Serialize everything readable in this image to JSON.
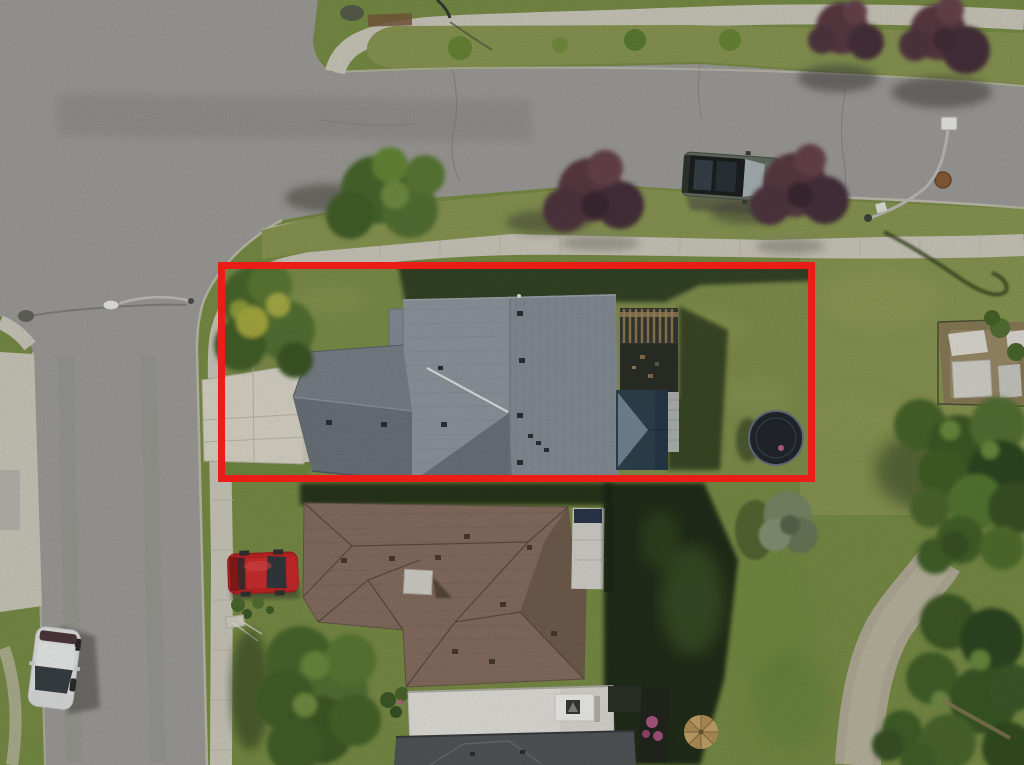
{
  "scene": {
    "kind": "aerial-drone-photo",
    "subject": "suburban corner lot outlined with red property boundary",
    "annotation": "red rectangle marking listed property"
  },
  "colors": {
    "asphalt": "#a2a19d",
    "asphalt_dark": "#8d8d89",
    "concrete": "#d2cec1",
    "concrete_bright": "#e0dccd",
    "grass": "#7c9148",
    "grass_olive": "#8d9b55",
    "lot_lawn": "#85934f",
    "grass_shadow": "#243019",
    "tree_green": "#4c6a2e",
    "tree_green_light": "#678c38",
    "tree_yellow": "#bcbc47",
    "tree_purple": "#5b3b45",
    "tree_purple_dark": "#452f38",
    "spruce": "#7d8b69",
    "roof_gray": "#8a929a",
    "roof_gray_light": "#939ba3",
    "roof_gray_dark": "#6e7680",
    "roof_brown": "#8a7263",
    "roof_brown_dark": "#74604f",
    "roof_charcoal": "#54585b",
    "flat_roof": "#e9e8e1",
    "teal_roof": "#2f4450",
    "teal_roof_light": "#8093a0",
    "pergola_wood": "#9b8257",
    "pergola_dark": "#363a33",
    "deck_gray": "#b5b9b5",
    "boundary_red": "#ea1d17",
    "trampoline": "#23282e",
    "trampoline_rim": "#6b7380",
    "car_white": "#e9eaea",
    "car_red": "#c52525",
    "suv_body": "#667062",
    "glass_dark": "#333b40",
    "lamp_white": "#f0f0ec",
    "lamp_pole": "#c2c2be",
    "path_gravel": "#b7b19c",
    "manhole": "#8a5f3a",
    "garden_dirt": "#8d7c5b",
    "shed_white": "#e5e3da",
    "flower_pink": "#c05f92"
  },
  "objects": {
    "boundary": "property-boundary",
    "main_house": "gray-hip-roof-house",
    "rear_deck": "wood-pergola-deck",
    "trampoline": "backyard-trampoline",
    "neighbor_house": "brown-roof-house",
    "vehicles": [
      "parked-suv",
      "red-car",
      "white-hatchback"
    ],
    "street_lights": 3,
    "walking_path": "gravel-path",
    "garden": "rear-garden-with-sheds"
  }
}
